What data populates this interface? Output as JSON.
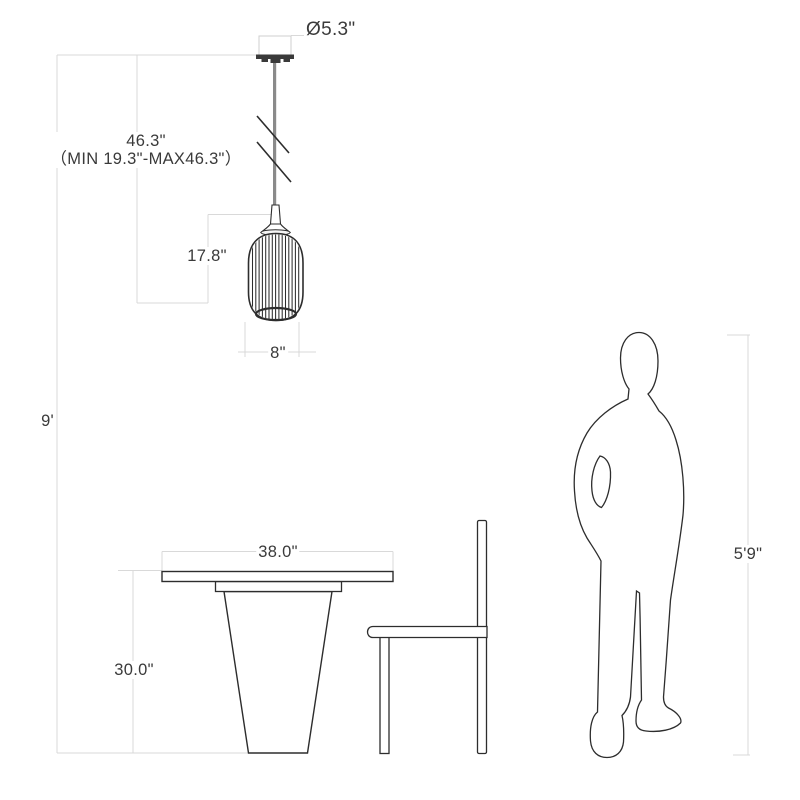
{
  "title": "Pendant light dimension diagram",
  "colors": {
    "background": "#ffffff",
    "drawing_line": "#2d2d2d",
    "dimension_line": "#d9d9d9",
    "label_text": "#3a3a3a",
    "cord": "#8a8a8a"
  },
  "dimensions": {
    "canopy_diameter": {
      "label": "Ø5.3\""
    },
    "cord_length": {
      "label": "46.3\"",
      "range": "（MIN 19.3\"-MAX46.3\"）"
    },
    "shade_height": {
      "label": "17.8\""
    },
    "shade_width": {
      "label": "8\""
    },
    "ceiling_height": {
      "label": "9'"
    },
    "table_width": {
      "label": "38.0\""
    },
    "table_height": {
      "label": "30.0\""
    },
    "person_height": {
      "label": "5'9\""
    }
  },
  "figures": {
    "pendant": "adjustable-cord pendant lamp with ribbed glass shade",
    "table": "pedestal dining table",
    "chair": "side chair",
    "person": "standing human silhouette for scale"
  }
}
